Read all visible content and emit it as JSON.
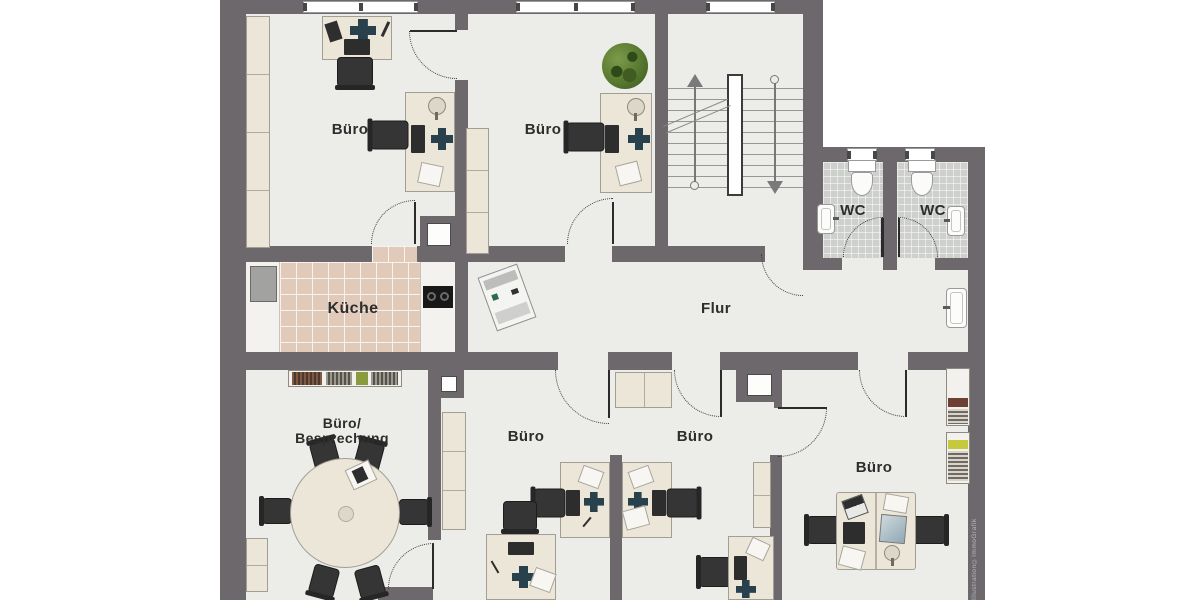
{
  "title": "Office floor plan",
  "rooms": [
    {
      "id": "buero-top-left",
      "label": "Büro"
    },
    {
      "id": "buero-top-middle",
      "label": "Büro"
    },
    {
      "id": "kueche",
      "label": "Küche"
    },
    {
      "id": "flur",
      "label": "Flur"
    },
    {
      "id": "wc-left",
      "label": "WC"
    },
    {
      "id": "wc-right",
      "label": "WC"
    },
    {
      "id": "buero-besprechung",
      "label_line1": "Büro/",
      "label_line2": "Besprechung"
    },
    {
      "id": "buero-bottom-left",
      "label": "Büro"
    },
    {
      "id": "buero-bottom-middle",
      "label": "Büro"
    },
    {
      "id": "buero-bottom-right",
      "label": "Büro"
    }
  ],
  "watermark": "Illustration©ImmoGrafik",
  "colors": {
    "wall": "#6c686c",
    "floor": "#ecede9",
    "kitchen_tile": "#e2cabb",
    "wc_tile": "#ced0ce",
    "furniture": "#ebe6d8",
    "chair": "#353535",
    "accent_teal": "#28414d",
    "plant_green": "#54752d",
    "background": "#ffffff"
  }
}
